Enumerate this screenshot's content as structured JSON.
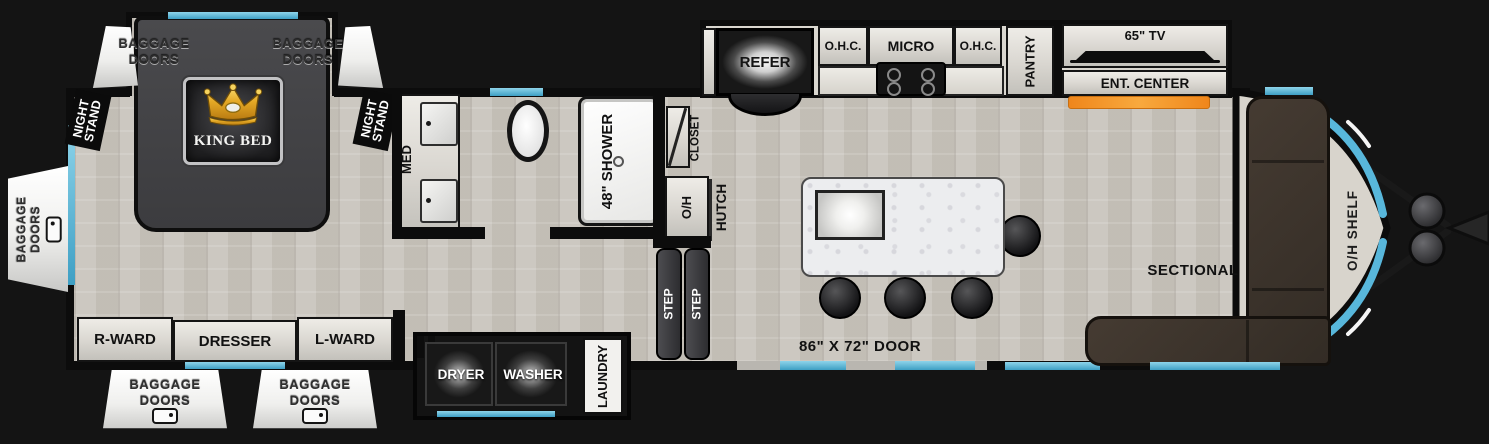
{
  "colors": {
    "accent_cyan": "#58b7db",
    "fireplace_orange": "#f5921e",
    "floor": "#c9c5bd",
    "wall": "#0c0c0c",
    "sofa_brown": "#3a332c",
    "cabinet_gray": "#e2e0db"
  },
  "exterior": {
    "baggage_top_left": {
      "line1": "BAGGAGE",
      "line2": "DOORS"
    },
    "baggage_top_right": {
      "line1": "BAGGAGE",
      "line2": "DOORS"
    },
    "baggage_rear": {
      "line1": "BAGGAGE",
      "line2": "DOORS"
    },
    "baggage_bottom_left": {
      "line1": "BAGGAGE",
      "line2": "DOORS"
    },
    "baggage_bottom_right": {
      "line1": "BAGGAGE",
      "line2": "DOORS"
    },
    "entry_door": "86\" X 72\" DOOR"
  },
  "bedroom": {
    "king_bed": "KING BED",
    "night_stand_left": {
      "line1": "NIGHT",
      "line2": "STAND"
    },
    "night_stand_right": {
      "line1": "NIGHT",
      "line2": "STAND"
    },
    "r_ward": "R-WARD",
    "dresser": "DRESSER",
    "l_ward": "L-WARD"
  },
  "bathroom": {
    "med": "MED",
    "shower": "48\" SHOWER",
    "closet": "CLOSET",
    "overhead": "O/H"
  },
  "laundry": {
    "dryer": "DRYER",
    "washer": "WASHER",
    "room": "LAUNDRY"
  },
  "kitchen": {
    "refer": "REFER",
    "ohc_left": "O.H.C.",
    "micro": "MICRO",
    "ohc_right": "O.H.C.",
    "pantry": "PANTRY",
    "hutch": "HUTCH",
    "step_front": "STEP",
    "step_back": "STEP"
  },
  "living": {
    "tv": "65\" TV",
    "ent_center": "ENT. CENTER",
    "sectional": "SECTIONAL",
    "oh_shelf": "O/H SHELF"
  }
}
